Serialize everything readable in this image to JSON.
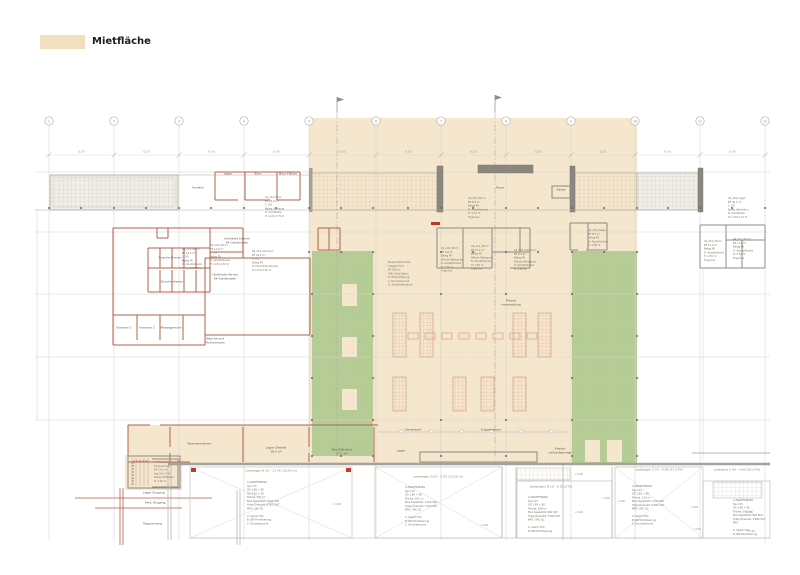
{
  "legend": {
    "label": "Mietfläche",
    "swatch_color": "#f2dfc0"
  },
  "colors": {
    "mietflaeche": "#f5e6ce",
    "gruenflaeche": "#b5cc97",
    "wall_red": "#b2604f",
    "wall_gray": "#8f8b85",
    "grid": "#d6d3cf"
  },
  "axis": {
    "bubbles": [
      "1",
      "2",
      "3",
      "4",
      "5",
      "6",
      "7",
      "8",
      "9",
      "10",
      "11",
      "12"
    ],
    "dim": "6.50"
  },
  "rooms": {
    "lager_top": "Lager",
    "buero_top": "Büro",
    "buero2_top": "Büro Fläche",
    "vordach": "Vordach",
    "foyer": "Foyer",
    "kasse": "Kasse",
    "umkleide_damen": "Umkleide Damen\n44 Garderoben",
    "umkleide_herren": "Umkleide Herren\n64 Garderoben",
    "dusche_damen": "Dusche Damen",
    "dusche_herren": "Dusche Herren",
    "vorraum1": "Vorraum 1",
    "vorraum2": "Vorraum 2",
    "massage": "Massageraum",
    "waesche": "Wäsche und\nTrockenraum",
    "fleisch": "Fleisch\nverarbeitung",
    "lager_gewoelbe": "Lager Gewölb\n18.0 m²",
    "box_pallisierie": "Box Pallisierie\n27.7 m²",
    "lager_klein": "Lager",
    "vorverkauf": "Vorverkauf",
    "kuppelrampe": "Kuppelrampe",
    "kleider": "Kleider\nverkaufsanlage",
    "warenannahme": "Warenannahme",
    "lager_eingang": "Lager Eingang",
    "pers_eingang": "Pers. Eingang",
    "treppe": "Treppenhaus"
  },
  "annotations": {
    "a1": "44_221_WC D\nBF 11.2 m²\n1. UG\nBelag PU\nD: Akustikdecke\nH: Licht 2.50 m",
    "a2": "44_222_WC H\nBF 12.6 m²\n1. UG\nBelag PU\nD: Akustikdecke\nH: Licht 2.50 m",
    "a3": "44_223_Duschen\nBF 18.4 m²\n1. UG\nBelag PU\nD: Feuchtraumdecke\nH: Licht 2.50 m",
    "a4": "44_210_Büro\nBF 24.0 m²\n1. OG\nBelag Linoleum\nD: Sichtbeton\nH: Licht 2.75 m",
    "a5": "Messe Multimedia\nAnlage Front\nBF  126 m²\n44H_Abst_Beton\nB: Bodenheizung\nC: Drucksensorik\nD: Akustikelemente",
    "a6": "44_240_WC H\nBF 9.8 m²\nBelag PU\nWände Weissputz\nD: Akustikdecke\nH: 2.50 m\nFugenlos",
    "a7": "44_241_WC D\nBF 10.4 m²\nBelag PU\nWände Weissputz\nD: Akustikdecke\nH: 2.50 m\nFugenlos",
    "a8": "44_242_Putzraum\nBF 6.2 m²\nBelag PU\nWände Weissputz\nD: Akustikdecke\nH: 2.50 m",
    "a9": "44_230_Kasse\nBF 8.5 m²\nBelag PU\nD: Akustikdecke\nH: 2.50 m",
    "a10": "44_310_WC D\nBF 11.0 m²\nBelag PU\nD: Akustikdecke\nH: 2.50 m\nFugenlos",
    "a11": "44_311_WC H\nBF 11.6 m²\nBelag PU\nD: Akustikdecke\nH: 2.50 m\nFugenlos",
    "a12": "44_300_Lager\nBF 42.1 m²\n1. UG\nBelag Hartbeton\nD: Sichtbeton\nH: Licht 2.75 m",
    "a13": "44_250_WC G\nBF 8.8 m²\nBelag PU\nD: Akustikdecke\nH: 2.50 m\nFugenlos",
    "a14": "44_TH_West\nTreppenhaus\nBF 14.2 m²\nStg 18×17.8\nBelag Hartbeton\nH: 2.50 m"
  },
  "bays": [
    {
      "header": "Lastwagen B 10 - 11 AC (16.50 m)",
      "body": "4 ANLIEFERUNG\nSpur 01\nQS 1.80 + 80\nQS 4.50 + 30\nFläche: 347 m²\nMax Kapazität: 1'500 St/h\nHubg Überzeit: 8'500 St/T\nMFK: UN / QL\n\nA: Spant TVG\nB: BW Plombierung\nC: Drucksensorik"
    },
    {
      "header": "Lastwagen N 10 - S 20 (12.50 m)",
      "body": "4 ANLIEFERUNG\nSpur 02\nQS 1.80 + 80\nFläche: 261 m²\nMax Kapazität: 1'200 St/h\nHubg Überzeit: 7'200 St/T\nMFK: UN / QL\n\nA: Spant TVG\nB: BW Plombierung\nC: Drucksensorik"
    },
    {
      "header": "Lastwagen N 10 - S 20 (270)",
      "body": "4 ANLIEFERUNG\nSpur 03\nQS 1.80 + 80\nFläche: 188 m²\nMax Kapazität: 900 St/h\nHubg Überzeit: 5'400 St/T\nMFK: UN / QL\n\nA: Spant TVG\nB: BW Plombierung"
    },
    {
      "header": "Lastwagen S 04 - 4.00 (22.5 PS)",
      "body": "4 ANLIEFERUNG\nSpur 04\nQS 1.80 + 80\nFläche: 214 m²\nMax Kapazität: 1'100 St/h\nHubg Überzeit: 6'300 St/T\nMFK: UN / QL\n\nA: Spant TVG\nB: BW Plombierung\nC: Drucksensorik"
    },
    {
      "header": "Lastwand S 04 - 4.00 (20.5 PS)",
      "body": "4 ANLIEFERUNG\nSpur 05\nQS 1.80 + 80\nFläche: 142 m²\nMax Kapazität: 800 St/h\nHubg Überzeit: 4'800 St/T\nMFK\n\nA: Spant TVG\nB: BW Plombierung"
    }
  ],
  "misc": {
    "level_mark": "« 0.00"
  }
}
